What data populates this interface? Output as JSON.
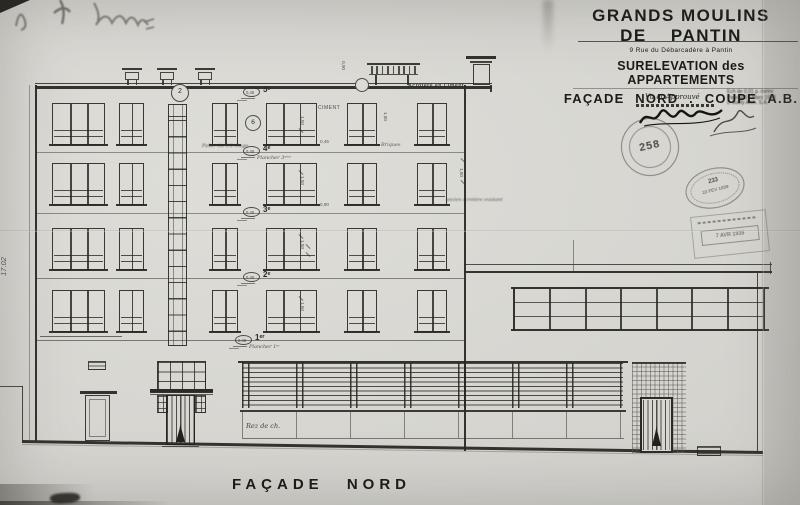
{
  "title_block": {
    "company_line1": "GRANDS MOULINS",
    "company_line2": "DE PANTIN",
    "address": "9 Rue du Débarcadère à Pantin",
    "subtitle1": "SURELEVATION des APPARTEMENTS",
    "subtitle2": "FAÇADE NORD . COUPE A.B.",
    "approval_label": "Vu et Approuvé",
    "scale_note": [
      "Ech de 0,01 p. mètre",
      "Paris le 24 Mars 1938",
      "L. Bailly Arch. S.A."
    ]
  },
  "stamps": {
    "round_number": "258",
    "oval_number": "233",
    "oval_date": "22 FEV 1939",
    "rect_date": "7 AVR 1939"
  },
  "annotations": {
    "left_height_dim": "17.02",
    "ciment": "CIMENT",
    "briques": "Briques",
    "acrotere_ciment": "Acrotère en Ciment",
    "palier": "Palier du 1/2 étage",
    "ancien_acrotere": "ancien acrotère existant",
    "rez_de_chaussee": "Rez de ch.",
    "detail_circle_top": "2",
    "detail_circle_mid": "6"
  },
  "floor_marks": [
    {
      "oval": "0,45",
      "tag": "5ᵉ",
      "note": ""
    },
    {
      "oval": "0,45",
      "tag": "4ᵉ",
      "note": "Plancher 3ᵉᵐᵉ"
    },
    {
      "oval": "0,45",
      "tag": "3ᵉ",
      "note": ""
    },
    {
      "oval": "0,45",
      "tag": "2ᵉ",
      "note": ""
    },
    {
      "oval": "0,45",
      "tag": "1ᵉʳ",
      "note": "Plancher 1ᵉʳ"
    }
  ],
  "dims": [
    "1,50",
    "1,50",
    "1,50",
    "1,50",
    "1,80",
    "1,80",
    "0,90",
    "0,45",
    "0,90"
  ],
  "caption": "FAÇADE NORD"
}
